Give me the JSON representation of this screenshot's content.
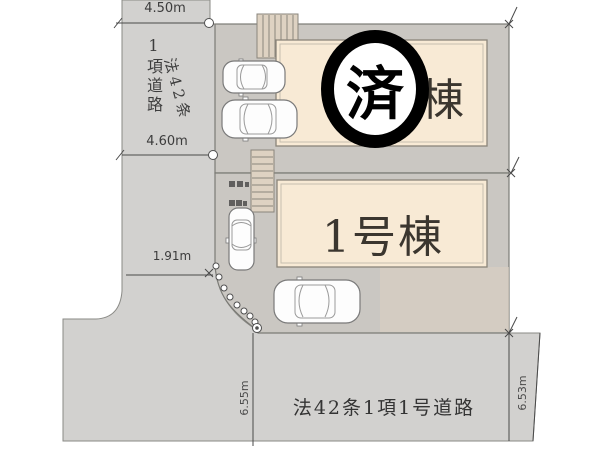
{
  "plan": {
    "buildings": [
      {
        "id": "building-2",
        "label": "2号棟",
        "status_stamp": "済"
      },
      {
        "id": "building-1",
        "label": "1号棟",
        "status_stamp": ""
      }
    ],
    "roads": [
      {
        "id": "left-road",
        "label_line1": "1項道路",
        "label_line2": "法42条"
      },
      {
        "id": "bottom-road",
        "label": "法42条1項1号道路"
      }
    ],
    "dimensions": {
      "left_road_top_width": "4.50m",
      "left_road_bottom_width": "4.60m",
      "left_setback": "1.91m",
      "bottom_road_left_frontage": "6.55m",
      "bottom_road_right_frontage": "6.53m"
    },
    "colors": {
      "background": "#ffffff",
      "road": "#d2d1cf",
      "parcel": "#cac7c2",
      "building_fill": "#f8ead5",
      "building_border": "#8b857a",
      "garden": "#d9cfc1",
      "stamp": "#000000"
    }
  }
}
